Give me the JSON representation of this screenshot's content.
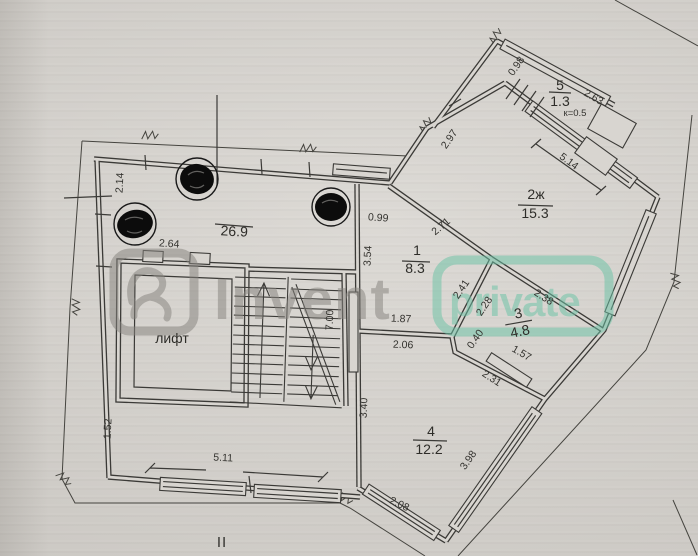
{
  "document": {
    "type": "floor-plan-scan",
    "section_mark": "II"
  },
  "rooms": {
    "hall": {
      "area": "26.9"
    },
    "lift": {
      "label": "лифт"
    },
    "r1": {
      "num": "1",
      "area": "8.3"
    },
    "r2": {
      "num": "2ж",
      "area": "15.3"
    },
    "r3": {
      "num": "3",
      "area": "4.8"
    },
    "r4": {
      "num": "4",
      "area": "12.2"
    },
    "r5": {
      "num": "5",
      "area": "1.3",
      "coef": "к=0.5"
    }
  },
  "dims": {
    "d214": "2.14",
    "d264": "2.64",
    "d099": "0.99",
    "d297": "2.97",
    "d098": "0.98",
    "d263": "2.63",
    "d514": "5.14",
    "d271": "2.71",
    "d354": "3.54",
    "d241": "2.41",
    "d228": "2.28",
    "d238": "2.38",
    "d187": "1.87",
    "d206": "2.06",
    "d040": "0.40",
    "d157": "1.57",
    "d231": "2.31",
    "d700": "7.00",
    "d340": "3.40",
    "d398": "3.98",
    "d208": "2.08",
    "d152": "1.52",
    "d511": "5.11"
  },
  "watermark": {
    "gray_text": "Invent",
    "teal_text": "private",
    "gray_color": "#87847f",
    "teal_color": "#6cc3a6"
  },
  "colors": {
    "paper": "#d8d5d0",
    "ink": "#3b3a37",
    "redaction": "#0c0c0c"
  }
}
